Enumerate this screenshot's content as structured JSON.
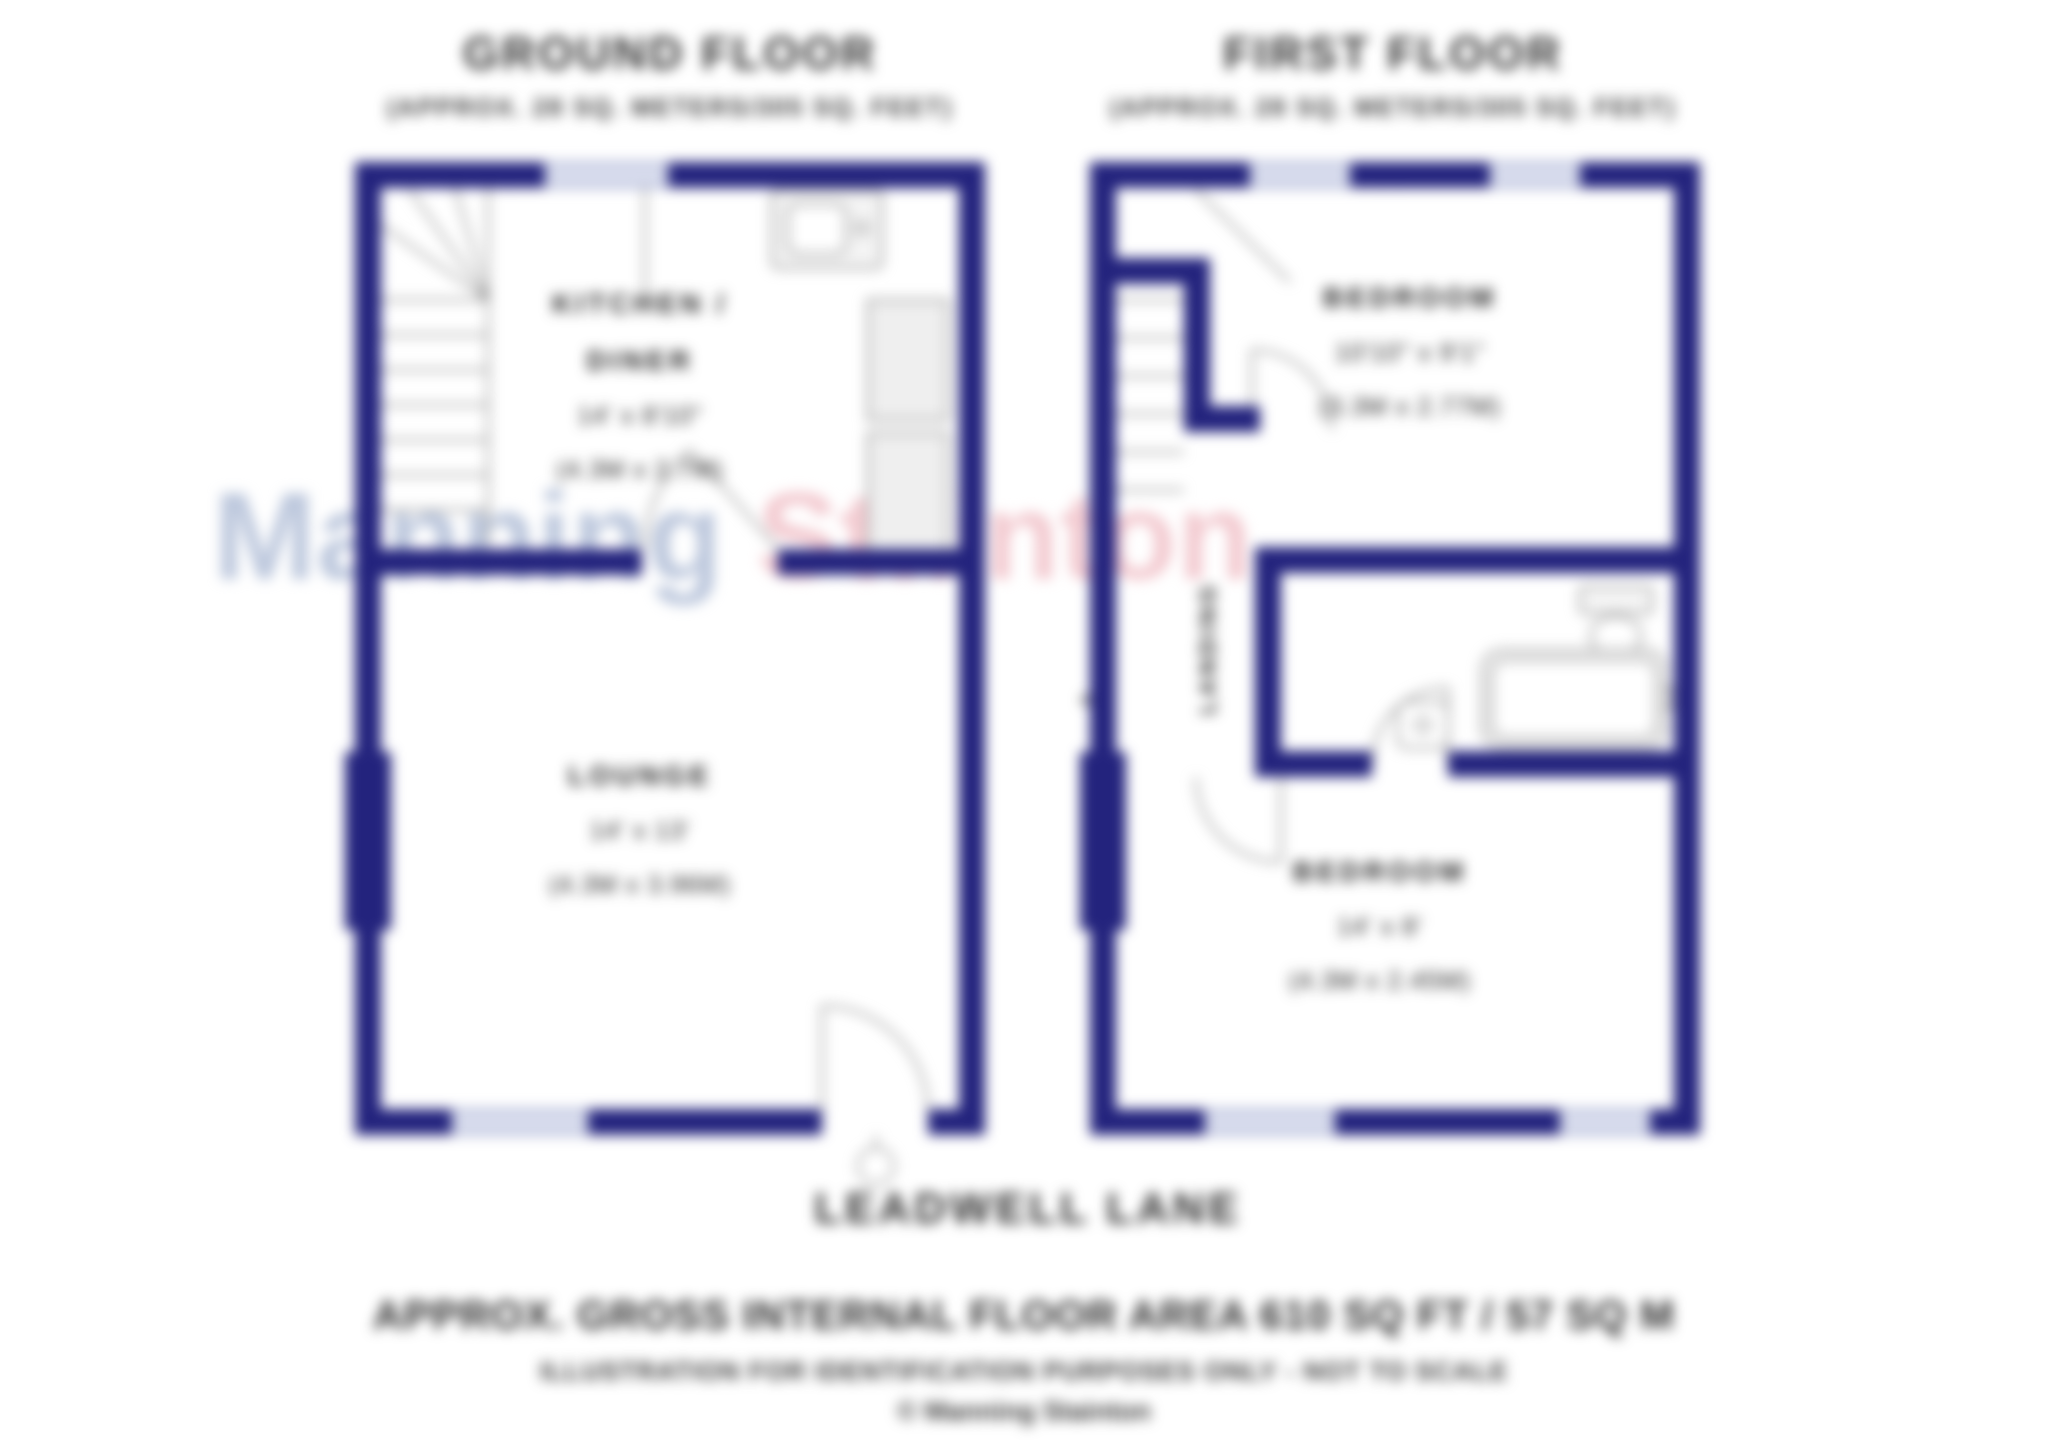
{
  "watermark": {
    "word1": "Manning",
    "word2": "Stainton",
    "word1_color": "#b6c2da",
    "word2_color": "#f2c6cc"
  },
  "colors": {
    "wall": "#23237d",
    "text": "#2e2e2e",
    "linework": "#8f8f8f",
    "window_tint": "#98a1cb"
  },
  "ground_floor": {
    "title": "GROUND FLOOR",
    "area_note": "(APPROX. 28 SQ. METERS/305 SQ. FEET)",
    "kitchen_diner": {
      "name_line1": "KITCHEN /",
      "name_line2": "DINER",
      "size_imperial": "14' x 8'10\"",
      "size_metric": "(4.3M x 2.7M)"
    },
    "lounge": {
      "name": "LOUNGE",
      "size_imperial": "14' x 13'",
      "size_metric": "(4.3M x 3.96M)"
    }
  },
  "first_floor": {
    "title": "FIRST FLOOR",
    "area_note": "(APPROX. 28 SQ. METERS/305 SQ. FEET)",
    "bedroom_one": {
      "name": "BEDROOM",
      "size_imperial": "10'10\" x 9'1\"",
      "size_metric": "(3.3M x 2.77M)"
    },
    "landing": {
      "name": "LANDING"
    },
    "bedroom_two": {
      "name": "BEDROOM",
      "size_imperial": "14' x 8'",
      "size_metric": "(4.3M x 2.45M)"
    }
  },
  "street_name": "LEADWELL LANE",
  "footer": {
    "area_summary": "APPROX. GROSS INTERNAL FLOOR AREA 610 SQ FT / 57 SQ M",
    "disclaimer": "ILLUSTRATION FOR IDENTIFICATION PURPOSES ONLY - NOT TO SCALE",
    "copyright": "© Manning Stainton"
  }
}
